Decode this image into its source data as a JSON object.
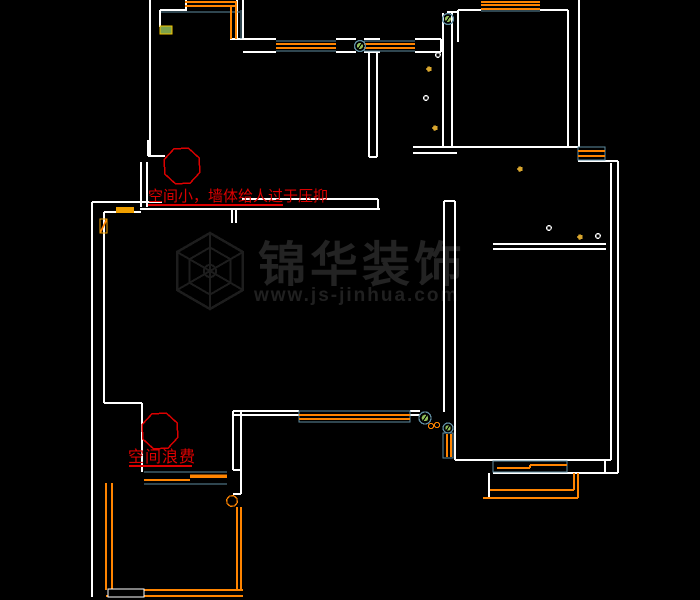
{
  "canvas": {
    "width": 700,
    "height": 600,
    "background": "#000000"
  },
  "colors": {
    "wall": "#ffffff",
    "window_frame": "#5e8ca0",
    "pipe_orange": "#ff8400",
    "fixture_yellow": "#d9a62e",
    "valve_green": "#8fbe5a",
    "annotation_red": "#dc0000",
    "watermark_gray": "#232323",
    "label_green_fill": "#7da24b",
    "label_yellow_border": "#f5c400"
  },
  "annotations": [
    {
      "id": "note-top",
      "text": "空间小，墙体给人过于压抑",
      "underline": [
        148,
        205,
        283,
        205
      ],
      "balloon": {
        "cx": 182,
        "cy": 166,
        "r": 19
      }
    },
    {
      "id": "note-bottom",
      "text": "空间浪费",
      "underline": [
        129,
        466,
        192,
        466
      ],
      "balloon": {
        "cx": 160,
        "cy": 431,
        "r": 19
      }
    }
  ],
  "watermark": {
    "brand": "锦华装饰",
    "url": "www.js-jinhua.com",
    "logo": {
      "cx": 210,
      "cy": 271,
      "r": 38
    }
  },
  "geometry": {
    "walls": [
      [
        150,
        0,
        150,
        156
      ],
      [
        160,
        10,
        160,
        27
      ],
      [
        160,
        10,
        187,
        10
      ],
      [
        186,
        0,
        186,
        10
      ],
      [
        148,
        140,
        148,
        156
      ],
      [
        148,
        156,
        165,
        156
      ],
      [
        141,
        162,
        141,
        207
      ],
      [
        147,
        162,
        147,
        207
      ],
      [
        237,
        0,
        237,
        39
      ],
      [
        243,
        0,
        243,
        39
      ],
      [
        230,
        39,
        276,
        39
      ],
      [
        243,
        52,
        276,
        52
      ],
      [
        336,
        39,
        356,
        39
      ],
      [
        336,
        52,
        356,
        52
      ],
      [
        364,
        39,
        380,
        39
      ],
      [
        364,
        52,
        380,
        52
      ],
      [
        415,
        39,
        441,
        39
      ],
      [
        415,
        52,
        441,
        52
      ],
      [
        441,
        39,
        441,
        52
      ],
      [
        369,
        52,
        369,
        157
      ],
      [
        377,
        52,
        377,
        157
      ],
      [
        369,
        157,
        377,
        157
      ],
      [
        443,
        13,
        443,
        147
      ],
      [
        452,
        13,
        452,
        147
      ],
      [
        447,
        12,
        458,
        12
      ],
      [
        458,
        10,
        458,
        42
      ],
      [
        458,
        10,
        481,
        10
      ],
      [
        540,
        10,
        568,
        10
      ],
      [
        568,
        10,
        568,
        147
      ],
      [
        579,
        0,
        579,
        147
      ],
      [
        413,
        147,
        578,
        147
      ],
      [
        413,
        153,
        457,
        153
      ],
      [
        242,
        199,
        378,
        199
      ],
      [
        140,
        209,
        380,
        209
      ],
      [
        92,
        202,
        162,
        202
      ],
      [
        104,
        212,
        141,
        212
      ],
      [
        378,
        199,
        378,
        209
      ],
      [
        232,
        209,
        232,
        223
      ],
      [
        236,
        209,
        236,
        223
      ],
      [
        92,
        202,
        92,
        597
      ],
      [
        104,
        212,
        104,
        403
      ],
      [
        104,
        403,
        142,
        403
      ],
      [
        142,
        403,
        142,
        472
      ],
      [
        233,
        411,
        299,
        411
      ],
      [
        233,
        415,
        299,
        415
      ],
      [
        410,
        411,
        420,
        411
      ],
      [
        410,
        415,
        420,
        415
      ],
      [
        233,
        411,
        233,
        470
      ],
      [
        241,
        411,
        241,
        494
      ],
      [
        233,
        470,
        241,
        470
      ],
      [
        233,
        494,
        241,
        494
      ],
      [
        444,
        201,
        444,
        412
      ],
      [
        455,
        201,
        455,
        460
      ],
      [
        444,
        201,
        455,
        201
      ],
      [
        493,
        244,
        606,
        244
      ],
      [
        493,
        249,
        606,
        249
      ],
      [
        578,
        161,
        618,
        161
      ],
      [
        611,
        163,
        611,
        460
      ],
      [
        618,
        161,
        618,
        473
      ],
      [
        455,
        460,
        611,
        460
      ],
      [
        605,
        460,
        605,
        473
      ],
      [
        493,
        473,
        618,
        473
      ],
      [
        489,
        473,
        489,
        499
      ]
    ],
    "teal_lines": [
      [
        276,
        41,
        336,
        41
      ],
      [
        276,
        51,
        336,
        51
      ],
      [
        364,
        41,
        415,
        41
      ],
      [
        364,
        51,
        415,
        51
      ],
      [
        481,
        11,
        540,
        11
      ],
      [
        241,
        10,
        241,
        39
      ],
      [
        161,
        12,
        240,
        12
      ],
      [
        144,
        472,
        227,
        472
      ],
      [
        144,
        484,
        227,
        484
      ]
    ],
    "teal_rects": [
      [
        578,
        147,
        27,
        13
      ],
      [
        443,
        433,
        10,
        25
      ],
      [
        493,
        461,
        74,
        11
      ],
      [
        299,
        411,
        111,
        11
      ]
    ],
    "orange_lines": [
      [
        185,
        2,
        237,
        2
      ],
      [
        185,
        6,
        237,
        6
      ],
      [
        231,
        6,
        231,
        39
      ],
      [
        236,
        2,
        236,
        39
      ],
      [
        276,
        44,
        336,
        44
      ],
      [
        276,
        48,
        336,
        48
      ],
      [
        364,
        44,
        415,
        44
      ],
      [
        364,
        48,
        415,
        48
      ],
      [
        481,
        2,
        540,
        2
      ],
      [
        481,
        5,
        540,
        5
      ],
      [
        481,
        9,
        540,
        9
      ],
      [
        578,
        151,
        605,
        151
      ],
      [
        578,
        156,
        605,
        156
      ],
      [
        299,
        415,
        410,
        415
      ],
      [
        299,
        419,
        410,
        419
      ],
      [
        447,
        434,
        447,
        457
      ],
      [
        451,
        434,
        451,
        457
      ],
      [
        497,
        468,
        530,
        468
      ],
      [
        530,
        465,
        567,
        465
      ],
      [
        530,
        465,
        530,
        468
      ],
      [
        490,
        490,
        574,
        490
      ],
      [
        483,
        498,
        578,
        498
      ],
      [
        574,
        473,
        574,
        490
      ],
      [
        578,
        473,
        578,
        498
      ],
      [
        144,
        480,
        190,
        480
      ],
      [
        106,
        483,
        106,
        590
      ],
      [
        112,
        483,
        112,
        590
      ],
      [
        112,
        590,
        243,
        590
      ],
      [
        106,
        596,
        243,
        596
      ],
      [
        237,
        507,
        237,
        590
      ],
      [
        241,
        507,
        241,
        590
      ],
      [
        100,
        233,
        107,
        219
      ]
    ],
    "orange_thick": [
      [
        190,
        476,
        227,
        476
      ]
    ],
    "rects": [
      {
        "x": 160,
        "y": 26,
        "w": 12,
        "h": 8,
        "fill": "#7da24b",
        "stroke": "#f5c400"
      },
      {
        "x": 116,
        "y": 207,
        "w": 18,
        "h": 6,
        "fill": "#f0a000",
        "stroke": "none"
      },
      {
        "x": 100,
        "y": 219,
        "w": 7,
        "h": 14,
        "fill": "none",
        "stroke": "#f0a000"
      },
      {
        "x": 108,
        "y": 589,
        "w": 36,
        "h": 8,
        "fill": "#000000",
        "stroke": "#ffffff"
      }
    ],
    "green_valves": [
      [
        360,
        46,
        5.5
      ],
      [
        448,
        19,
        5.5
      ],
      [
        425,
        418,
        6
      ],
      [
        448,
        428,
        5
      ]
    ],
    "white_dots": [
      [
        438,
        55
      ],
      [
        426,
        98
      ],
      [
        549,
        228
      ],
      [
        598,
        236
      ]
    ],
    "yellow_dots": [
      [
        429,
        69
      ],
      [
        435,
        128
      ],
      [
        520,
        169
      ],
      [
        580,
        237
      ]
    ],
    "orange_circles": [
      [
        431,
        426,
        2.5
      ],
      [
        437,
        425,
        2.5
      ]
    ],
    "orange_octagon": {
      "cx": 232,
      "cy": 501,
      "r": 5.5
    }
  }
}
